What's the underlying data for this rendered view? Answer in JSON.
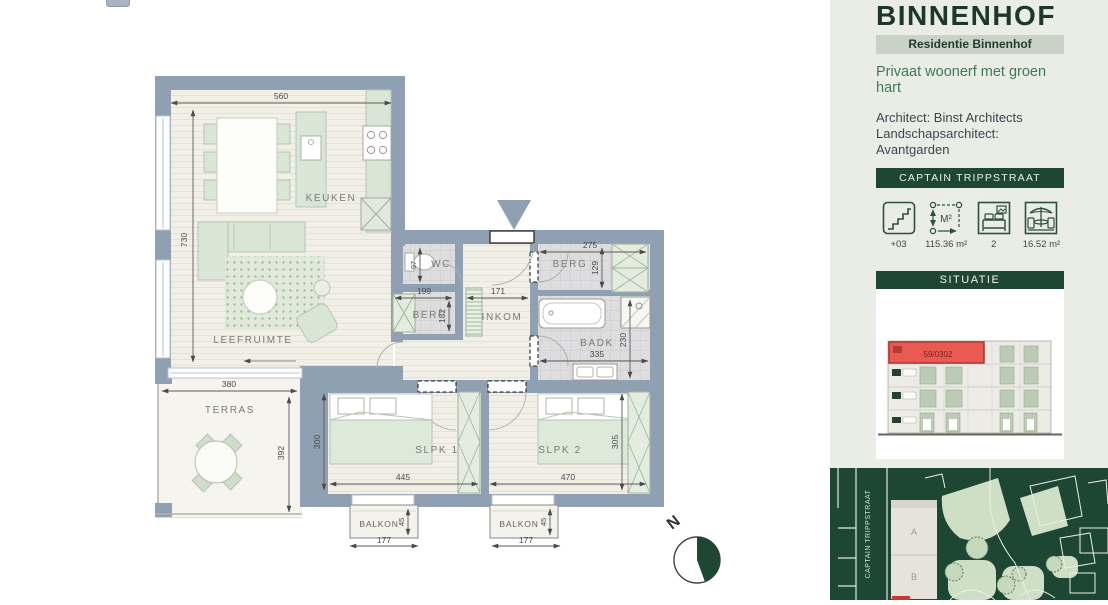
{
  "colors": {
    "accent_dark_green": "#1d4733",
    "band_green": "#c9d2c4",
    "sidebar_background": "#e9ede6",
    "tagline_green": "#3f7a54",
    "wall_blue_gray": "#8fa0b3",
    "highlight_red": "#ea5a52",
    "furniture_green": "#d9e6d6"
  },
  "sidebar": {
    "title": "BINNENHOF",
    "subtitle": "Residentie Binnenhof",
    "tagline": "Privaat woonerf met groen hart",
    "architect": "Architect: Binst Architects",
    "landscape_architect": "Landschapsarchitect: Avantgarden",
    "address": "CAPTAIN TRIPPSTRAAT 59/0302",
    "area_icon_glyph": "M²",
    "stats": [
      {
        "name": "floor",
        "value": "+03"
      },
      {
        "name": "living-area",
        "value": "115.36 m²"
      },
      {
        "name": "bedrooms",
        "value": "2"
      },
      {
        "name": "terrace-area",
        "value": "16.52 m²"
      }
    ],
    "situatie": {
      "header": "SITUATIE",
      "highlight_label": "59/0302"
    }
  },
  "site_map": {
    "street_label": "CAPTAIN TRIPPSTRAAT",
    "block_a": "A",
    "block_b": "B"
  },
  "floor_plan": {
    "compass_label": "N",
    "rooms": {
      "keuken": "KEUKEN",
      "leefruimte": "LEEFRUIMTE",
      "terras": "TERRAS",
      "wc": "WC",
      "berg_left": "BERG",
      "berg_right": "BERG",
      "inkom": "INKOM",
      "badk": "BADK",
      "slpk1": "SLPK 1",
      "slpk2": "SLPK 2",
      "balkon1": "BALKON",
      "balkon2": "BALKON"
    },
    "dims": {
      "keuken_breedte": "560",
      "woonruimte_hoogte": "730",
      "terras_breedte": "380",
      "terras_diepte": "392",
      "wc_breedte": "97",
      "berg_left_breedte": "199",
      "berg_left_diepte": "132",
      "inkom_breedte": "171",
      "berg_right_breedte": "275",
      "berg_right_diepte": "129",
      "badk_breedte": "335",
      "badk_diepte": "230",
      "slpk1_diepte": "300",
      "slpk1_breedte": "445",
      "slpk2_breedte": "470",
      "slpk2_diepte": "305",
      "balkon1_breedte": "177",
      "balkon1_diepte": "45",
      "balkon2_breedte": "177",
      "balkon2_diepte": "45"
    }
  }
}
